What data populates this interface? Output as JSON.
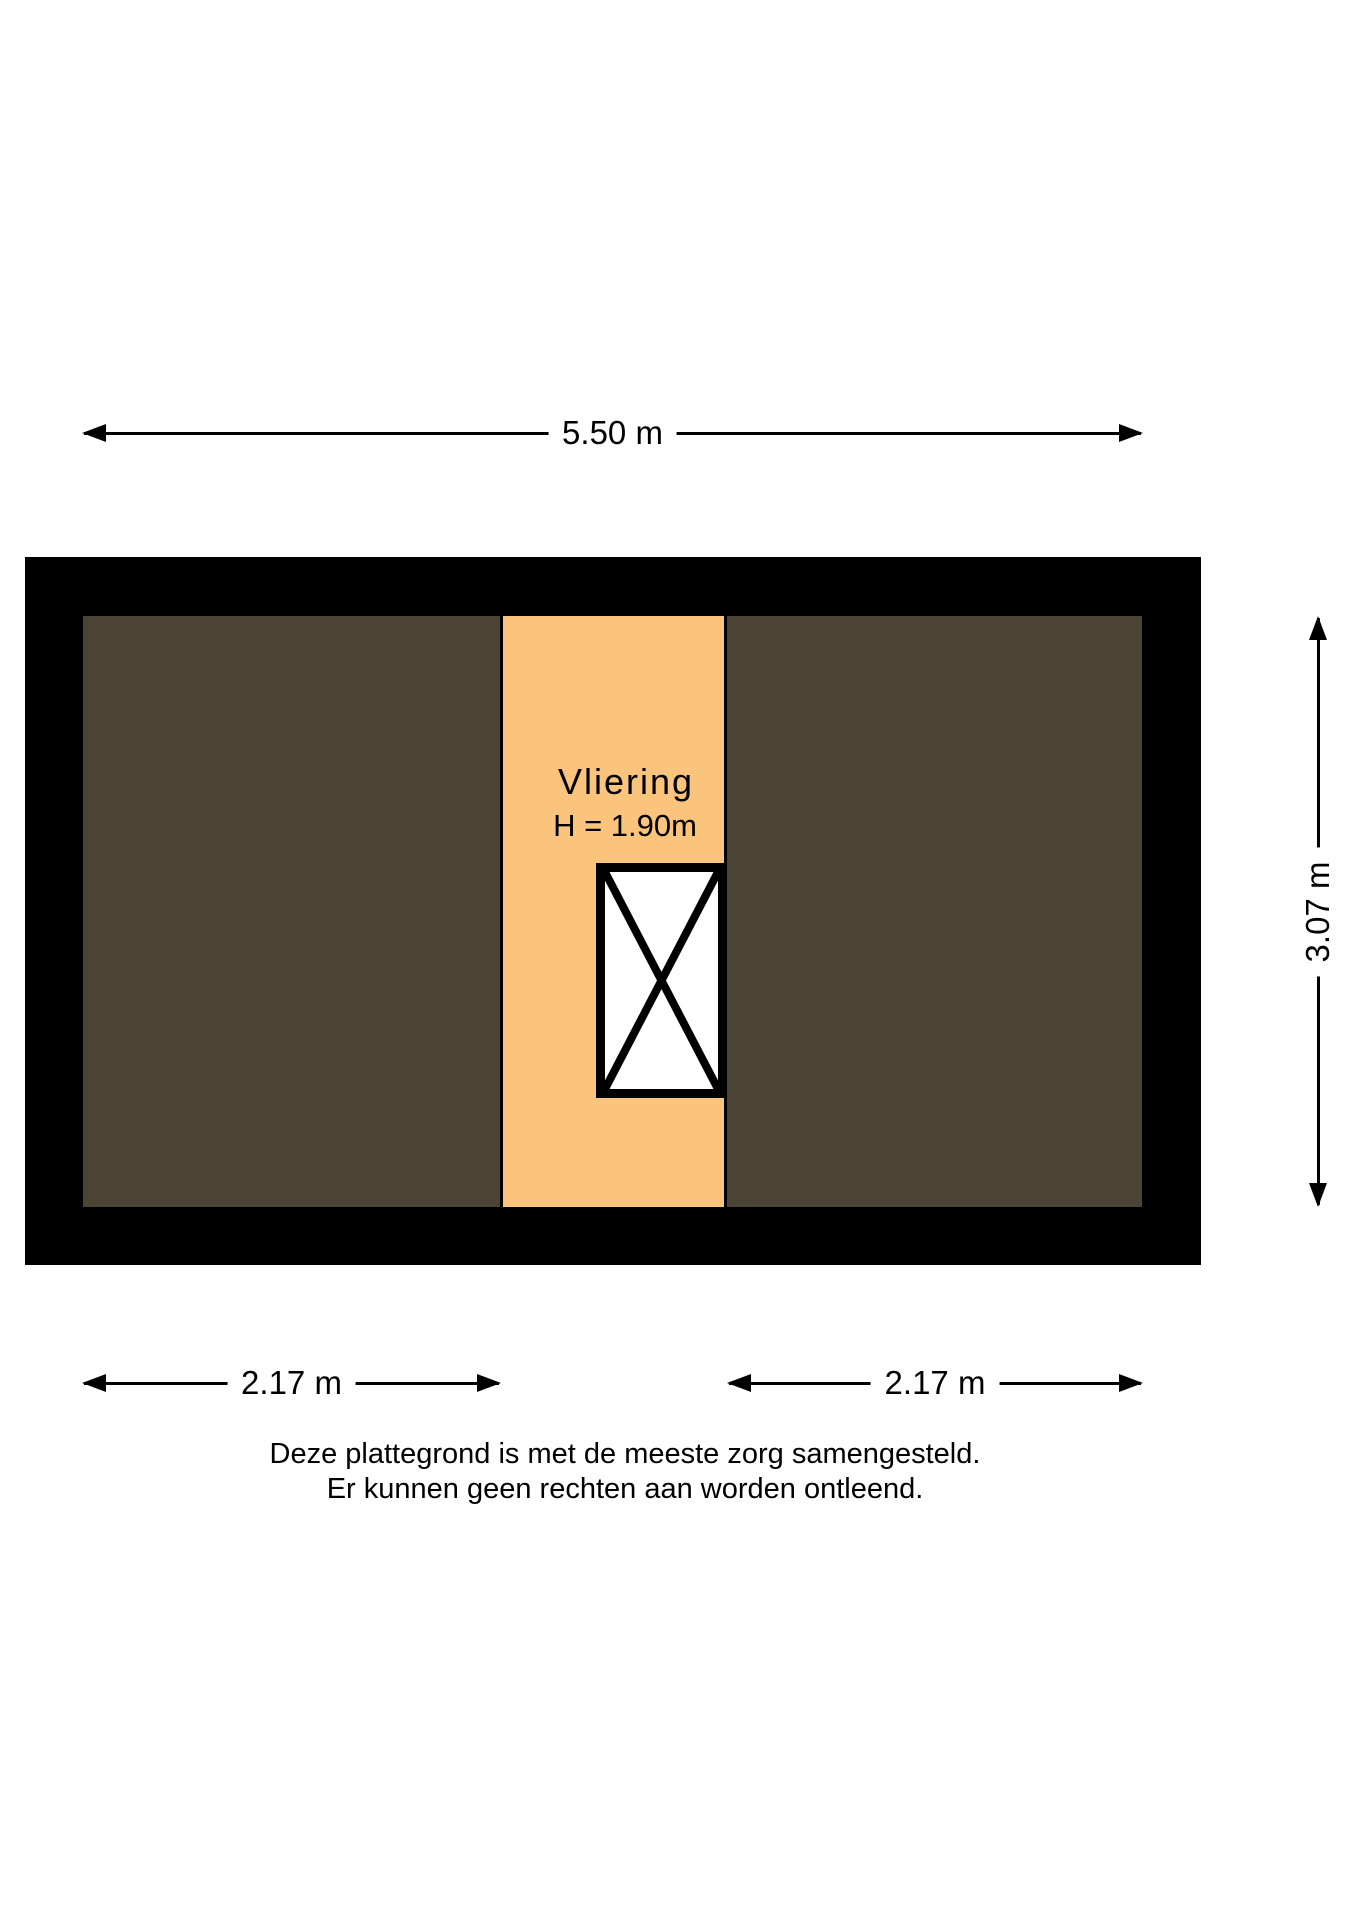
{
  "floor_plan": {
    "room_label": "Vliering",
    "room_height_label": "H = 1.90m",
    "colors": {
      "wall": "#000000",
      "low_headroom_area": "#4B4334",
      "loft_floor": "#FAC47C",
      "stair_fill": "#FFFFFF",
      "background": "#FFFFFF"
    }
  },
  "dimensions": {
    "top": "5.50 m",
    "right": "3.07 m",
    "bottom_left": "2.17 m",
    "bottom_right": "2.17 m"
  },
  "disclaimer": {
    "line1": "Deze plattegrond is met de meeste zorg samengesteld.",
    "line2": "Er kunnen geen rechten aan worden ontleend."
  }
}
